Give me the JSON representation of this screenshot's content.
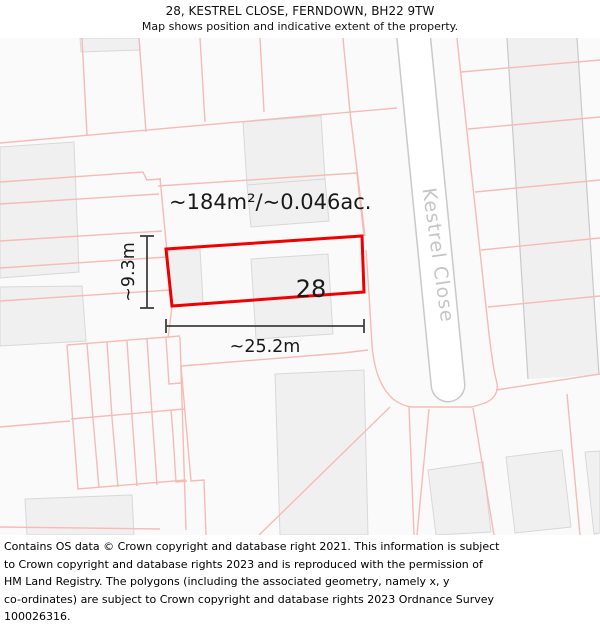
{
  "header": {
    "title_line1": "28, KESTREL CLOSE, FERNDOWN, BH22 9TW",
    "title_line2": "Map shows position and indicative extent of the property."
  },
  "map": {
    "road_label": "Kestrel Close",
    "property_number": "28",
    "area_label": "~184m²/~0.046ac.",
    "width_label": "~25.2m",
    "height_label": "~9.3m",
    "colors": {
      "property_outline": "#ee0000",
      "parcel_line": "#f5bbb7",
      "building_fill": "#f1f0f0",
      "building_stroke": "#d9d7d7",
      "road_edge": "#c9c9c9",
      "dimension_line": "#3f3f3f",
      "road_label_text": "#c5c5c5"
    }
  },
  "footer": {
    "lines": [
      "Contains OS data © Crown copyright and database right 2021. This information is subject",
      "to Crown copyright and database rights 2023 and is reproduced with the permission of",
      "HM Land Registry. The polygons (including the associated geometry, namely x, y",
      "co-ordinates) are subject to Crown copyright and database rights 2023 Ordnance Survey",
      "100026316."
    ]
  }
}
